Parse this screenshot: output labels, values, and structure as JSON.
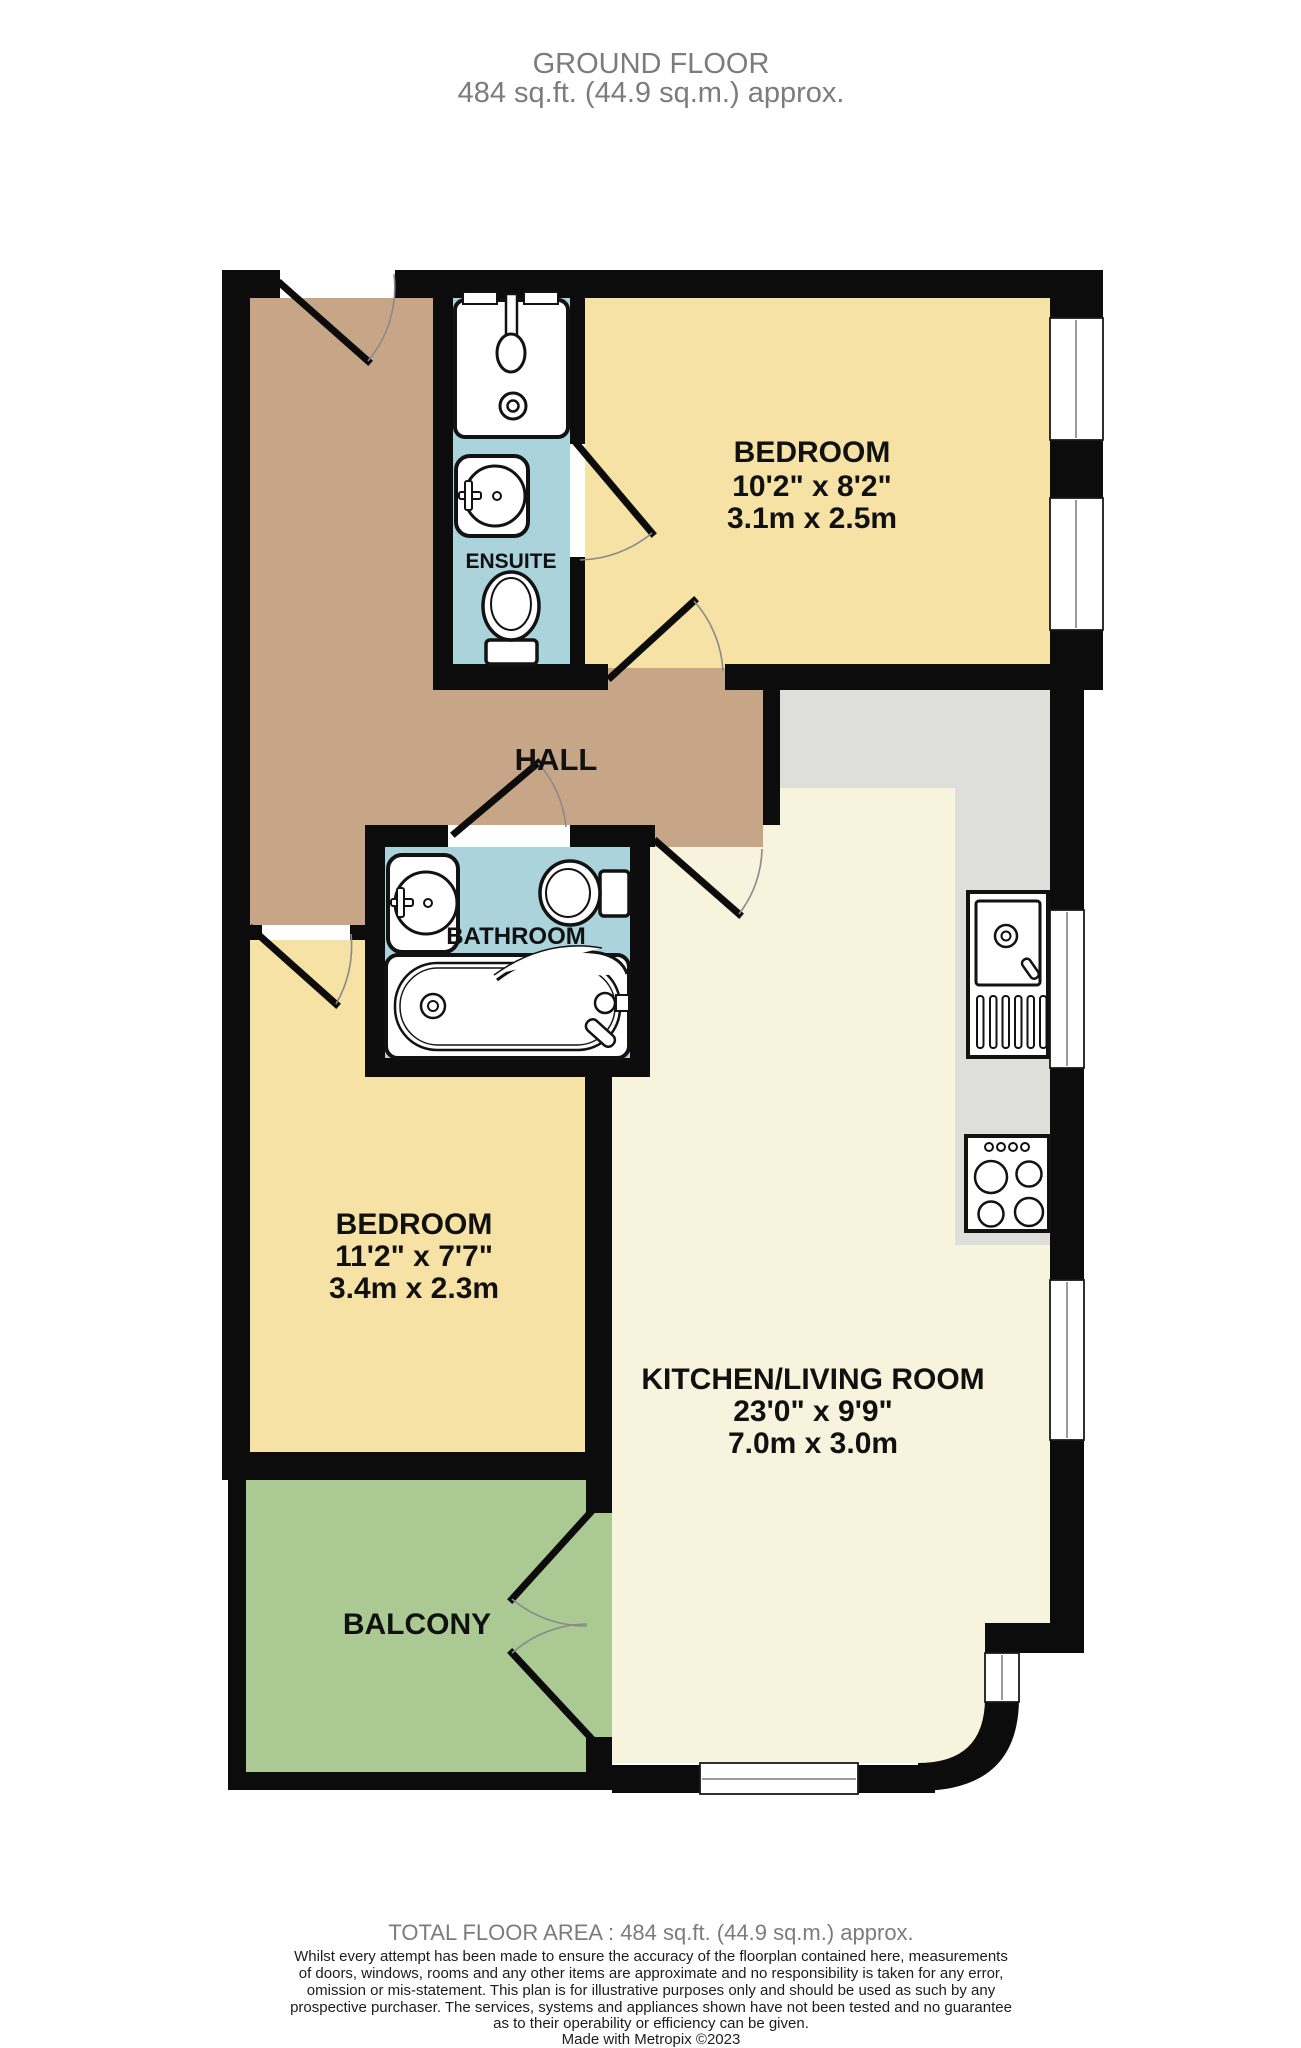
{
  "title": {
    "line1": "GROUND FLOOR",
    "line2": "484 sq.ft. (44.9 sq.m.) approx."
  },
  "rooms": {
    "bedroom1": {
      "label": "BEDROOM",
      "size_imperial": "10'2\" x 8'2\"",
      "size_metric": "3.1m x 2.5m"
    },
    "bedroom2": {
      "label": "BEDROOM",
      "size_imperial": "11'2\" x 7'7\"",
      "size_metric": "3.4m x 2.3m"
    },
    "kitchen_living": {
      "label": "KITCHEN/LIVING ROOM",
      "size_imperial": "23'0\" x 9'9\"",
      "size_metric": "7.0m x 3.0m"
    },
    "hall": {
      "label": "HALL"
    },
    "ensuite": {
      "label": "ENSUITE"
    },
    "bathroom": {
      "label": "BATHROOM"
    },
    "balcony": {
      "label": "BALCONY"
    }
  },
  "footer": {
    "total_area": "TOTAL FLOOR AREA : 484 sq.ft. (44.9 sq.m.) approx.",
    "disclaimer_lines": [
      "Whilst every attempt has been made to ensure the accuracy of the floorplan contained here, measurements",
      "of doors, windows, rooms and any other items are approximate and no responsibility is taken for any error,",
      "omission or mis-statement. This plan is for illustrative purposes only and should be used as such by any",
      "prospective purchaser. The services, systems and appliances shown have not been tested and no guarantee",
      "as to their operability or efficiency can be given."
    ],
    "credit": "Made with Metropix ©2023"
  },
  "colors": {
    "hall": "#C7A687",
    "bedroom": "#F6E2A4",
    "bathroom": "#AAD3DC",
    "kitchen": "#F8F3DC",
    "counter": "#DEDEDB",
    "balcony": "#ABCA93",
    "wall": "#0C0C0C"
  }
}
